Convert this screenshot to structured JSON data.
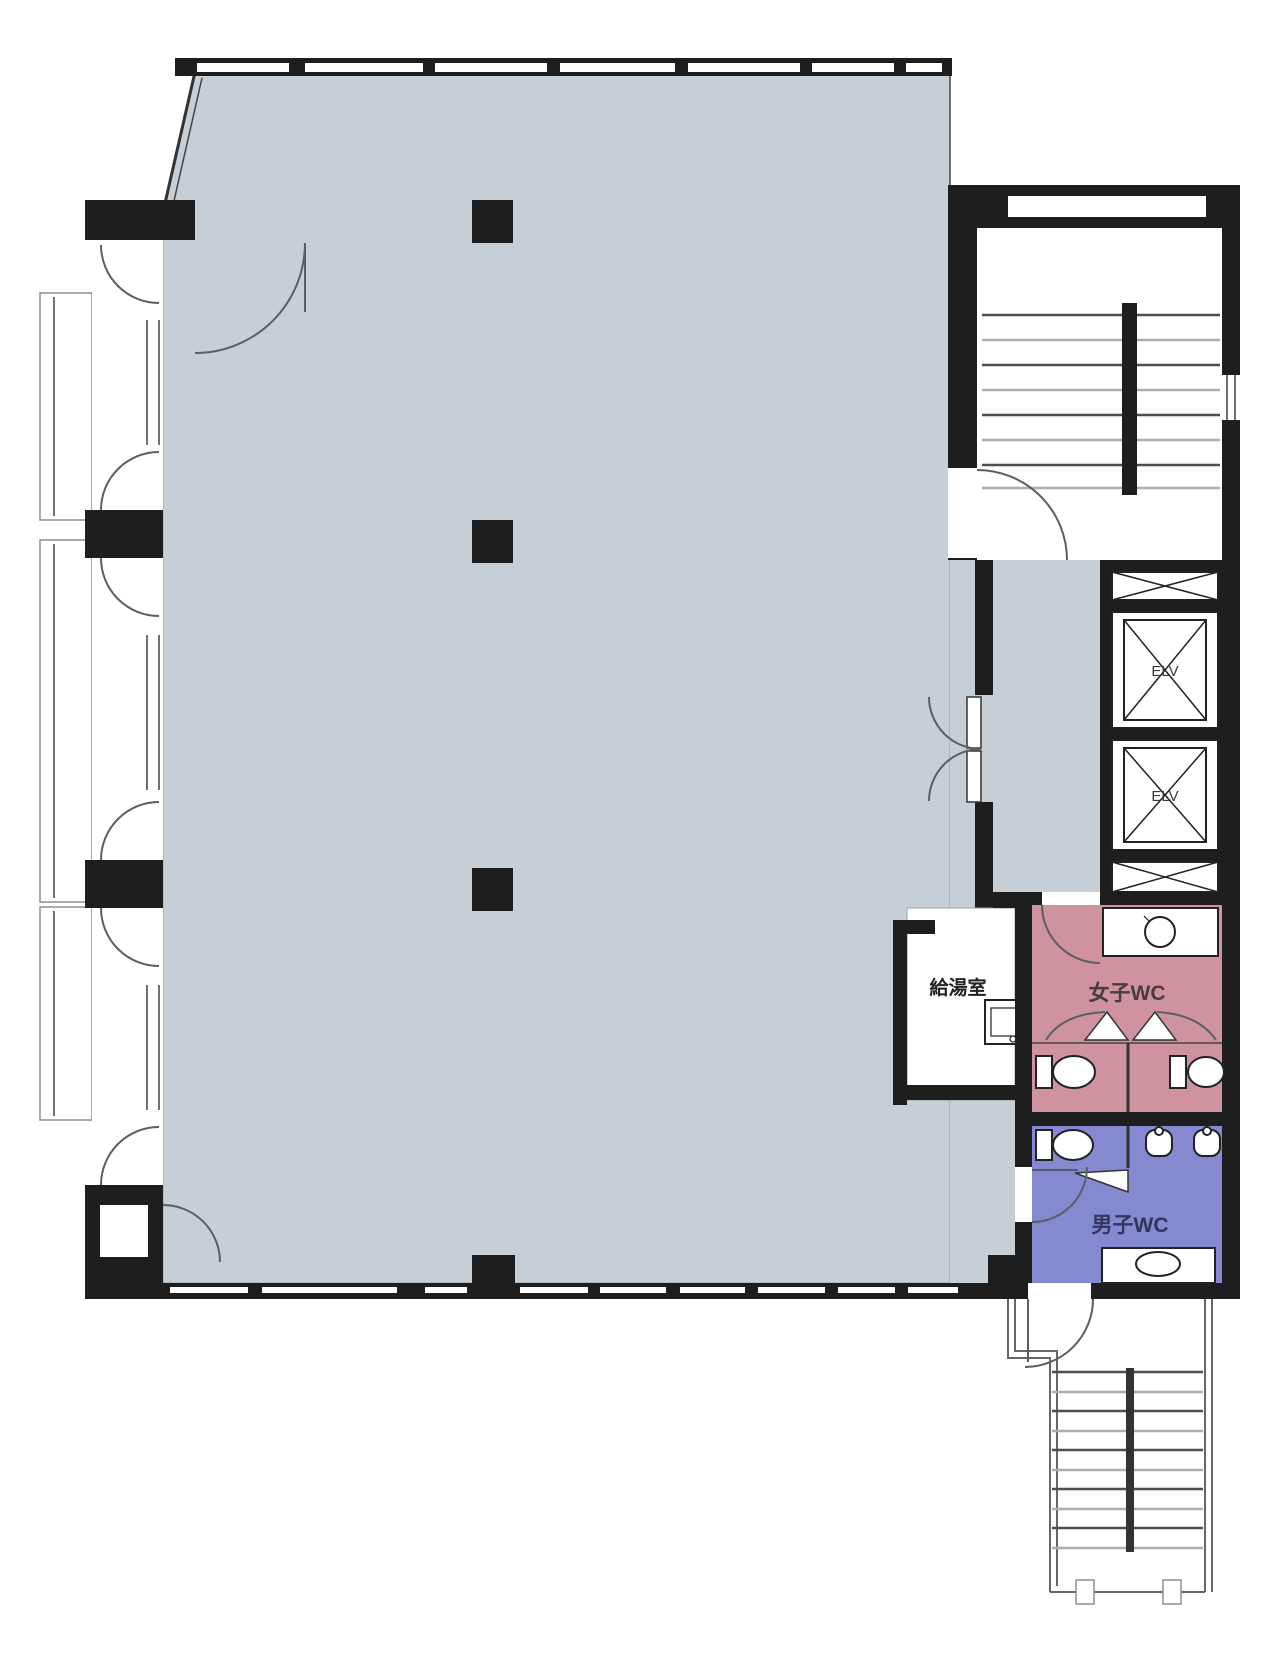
{
  "page": {
    "title": "Office building floor plan"
  },
  "labels": {
    "elevator": "ELV",
    "kitchenette": "給湯室",
    "womens_wc": "女子WC",
    "mens_wc": "男子WC"
  },
  "colors": {
    "background": "#ffffff",
    "wall": "#1e1e1e",
    "office_floor": "#c6cfd5",
    "womens_wc_floor": "#cf93a0",
    "mens_wc_floor": "#8589cf",
    "fixture_outline": "#222222",
    "door_arc": "#5a5f63",
    "tread_dark": "#4a4f52",
    "tread_light": "#a8aeb2"
  },
  "rooms": [
    {
      "name": "office-area",
      "label": ""
    },
    {
      "name": "north-stairwell",
      "label": ""
    },
    {
      "name": "elevator-1",
      "label": "ELV"
    },
    {
      "name": "elevator-2",
      "label": "ELV"
    },
    {
      "name": "kitchenette",
      "label": "給湯室"
    },
    {
      "name": "womens-toilet",
      "label": "女子WC"
    },
    {
      "name": "mens-toilet",
      "label": "男子WC"
    },
    {
      "name": "south-stairwell",
      "label": ""
    }
  ]
}
